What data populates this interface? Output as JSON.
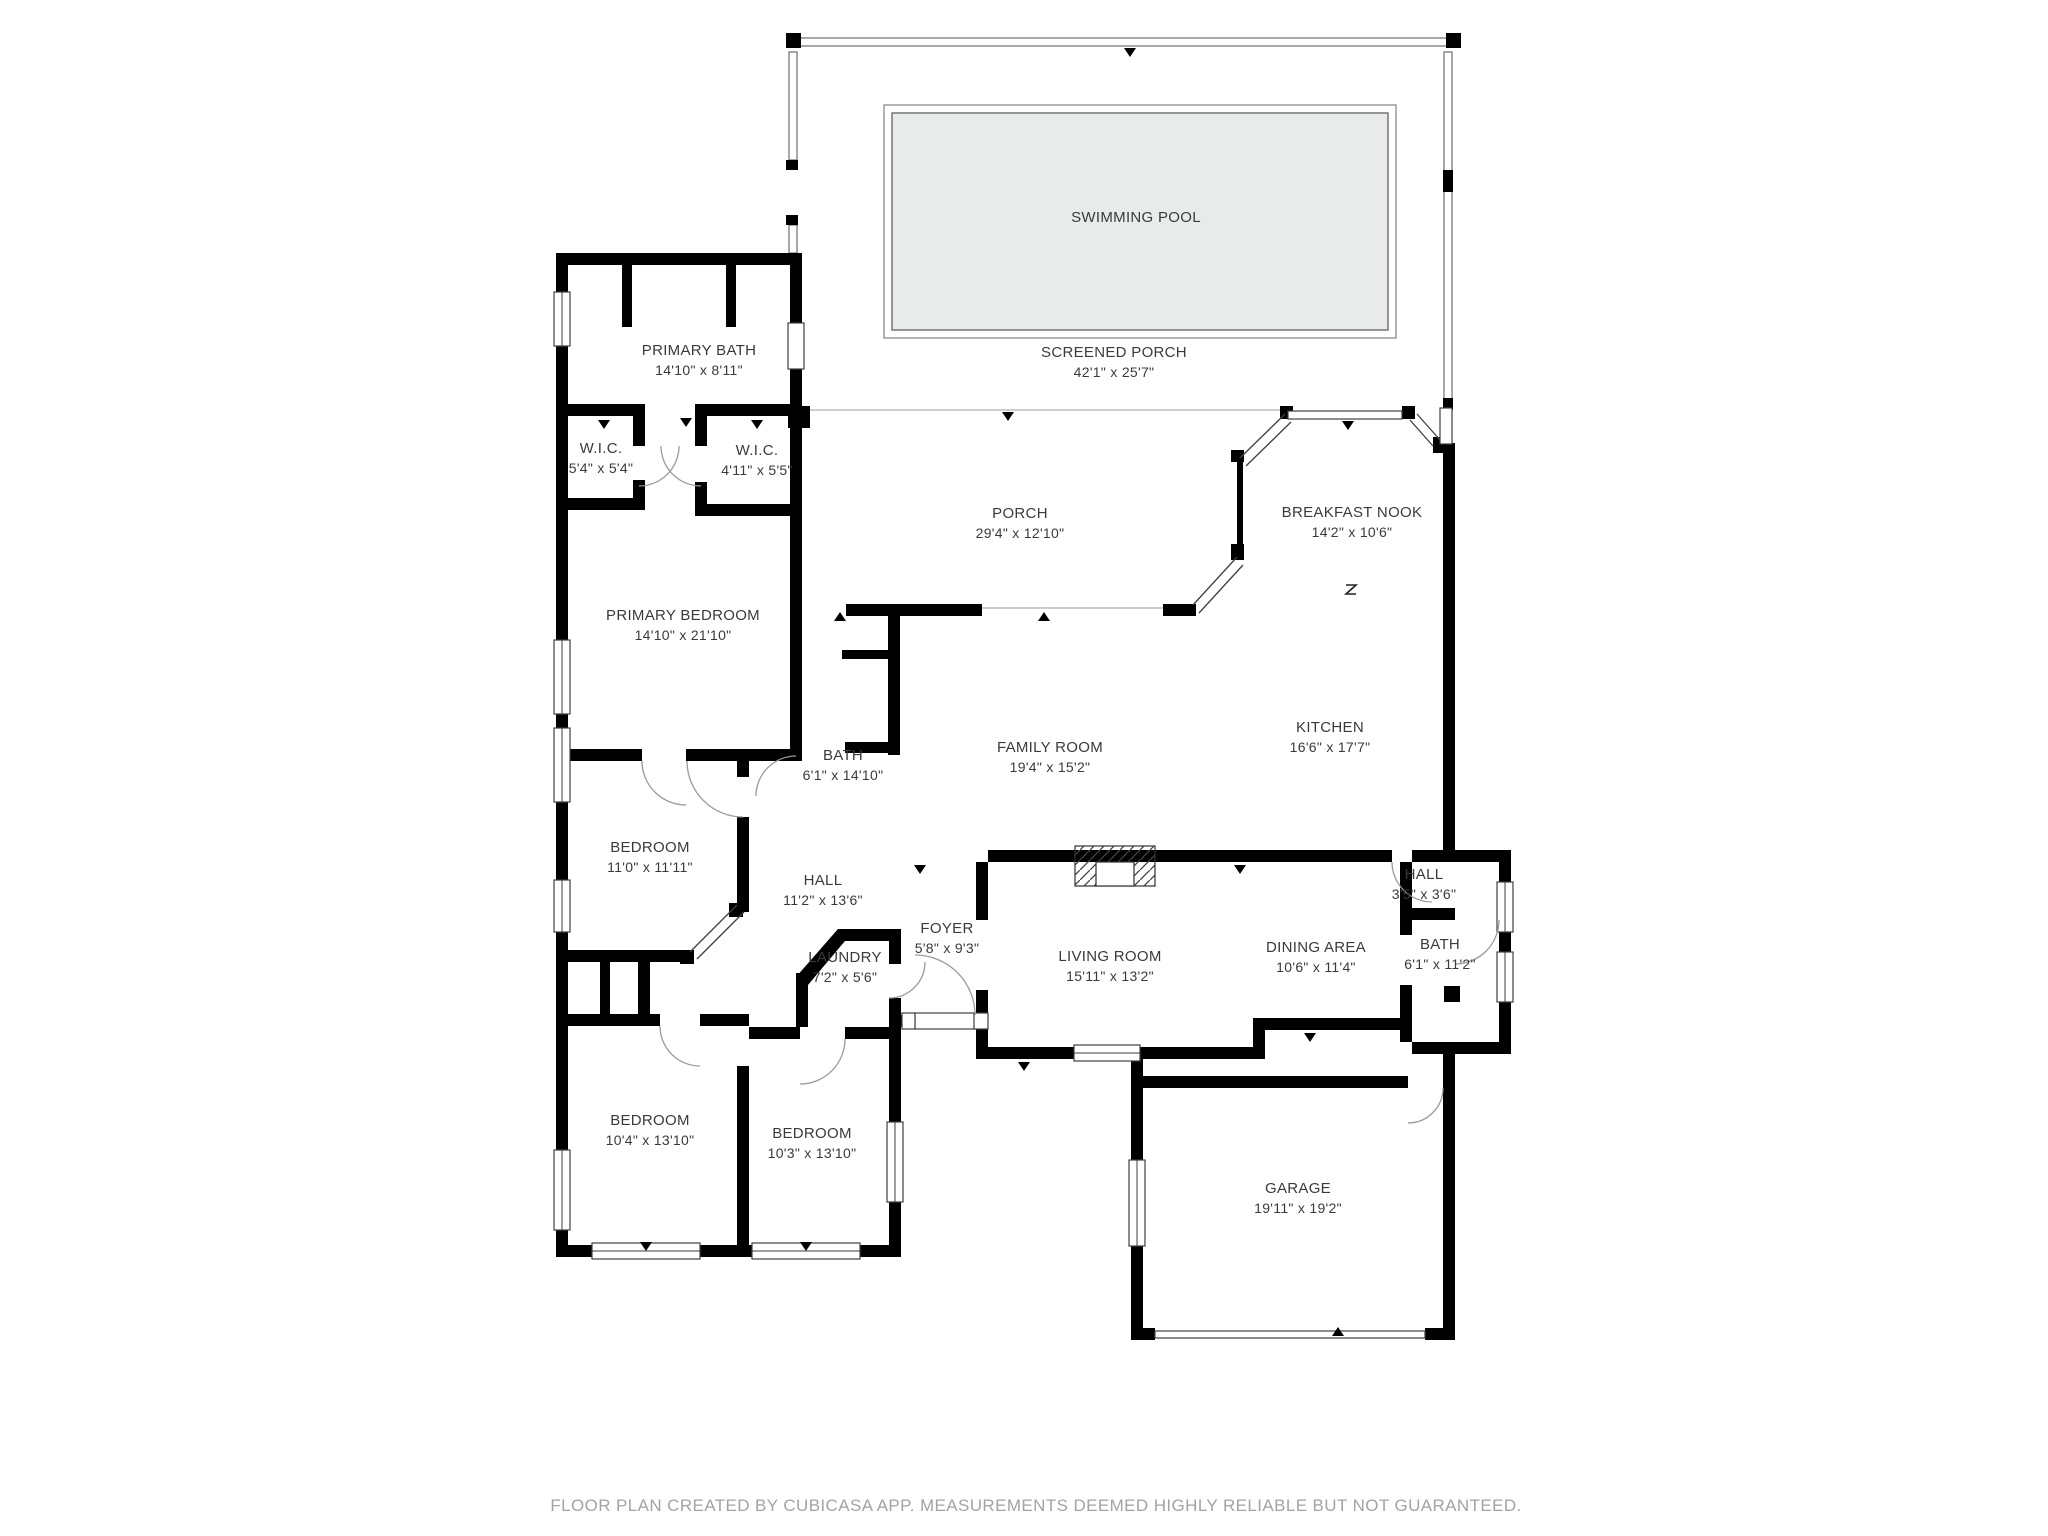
{
  "meta": {
    "app_attribution_visible": true
  },
  "colors": {
    "wall": "#000000",
    "pool_fill": "#e9ebeb",
    "pool_border": "#8a8a8a",
    "label_text": "#3a3a3a",
    "footer_text": "#a3a3a3",
    "open_boundary_line": "#c0c0c0",
    "background": "#ffffff"
  },
  "rooms": [
    {
      "id": "swimming-pool",
      "name": "SWIMMING POOL",
      "dims": ""
    },
    {
      "id": "screened-porch",
      "name": "SCREENED PORCH",
      "dims": "42'1\" x 25'7\""
    },
    {
      "id": "primary-bath",
      "name": "PRIMARY BATH",
      "dims": "14'10\" x 8'11\""
    },
    {
      "id": "wic-left",
      "name": "W.I.C.",
      "dims": "5'4\" x 5'4\""
    },
    {
      "id": "wic-right",
      "name": "W.I.C.",
      "dims": "4'11\" x 5'5\""
    },
    {
      "id": "porch",
      "name": "PORCH",
      "dims": "29'4\" x 12'10\""
    },
    {
      "id": "breakfast-nook",
      "name": "BREAKFAST NOOK",
      "dims": "14'2\" x 10'6\""
    },
    {
      "id": "primary-bedroom",
      "name": "PRIMARY BEDROOM",
      "dims": "14'10\" x 21'10\""
    },
    {
      "id": "bath-primary-hall",
      "name": "BATH",
      "dims": "6'1\" x 14'10\""
    },
    {
      "id": "family-room",
      "name": "FAMILY ROOM",
      "dims": "19'4\" x 15'2\""
    },
    {
      "id": "kitchen",
      "name": "KITCHEN",
      "dims": "16'6\" x 17'7\""
    },
    {
      "id": "bedroom-west",
      "name": "BEDROOM",
      "dims": "11'0\" x 11'11\""
    },
    {
      "id": "hall-main",
      "name": "HALL",
      "dims": "11'2\" x 13'6\""
    },
    {
      "id": "foyer",
      "name": "FOYER",
      "dims": "5'8\" x 9'3\""
    },
    {
      "id": "laundry",
      "name": "LAUNDRY",
      "dims": "7'2\" x 5'6\""
    },
    {
      "id": "living-room",
      "name": "LIVING ROOM",
      "dims": "15'11\" x 13'2\""
    },
    {
      "id": "dining-area",
      "name": "DINING AREA",
      "dims": "10'6\" x 11'4\""
    },
    {
      "id": "hall-small",
      "name": "HALL",
      "dims": "3'5\" x 3'6\""
    },
    {
      "id": "bath-right",
      "name": "BATH",
      "dims": "6'1\" x 11'2\""
    },
    {
      "id": "bedroom-south-left",
      "name": "BEDROOM",
      "dims": "10'4\" x 13'10\""
    },
    {
      "id": "bedroom-south-right",
      "name": "BEDROOM",
      "dims": "10'3\" x 13'10\""
    },
    {
      "id": "garage",
      "name": "GARAGE",
      "dims": "19'11\" x 19'2\""
    }
  ],
  "footer": {
    "text": "FLOOR PLAN CREATED BY CUBICASA APP. MEASUREMENTS DEEMED HIGHLY RELIABLE BUT NOT GUARANTEED."
  }
}
